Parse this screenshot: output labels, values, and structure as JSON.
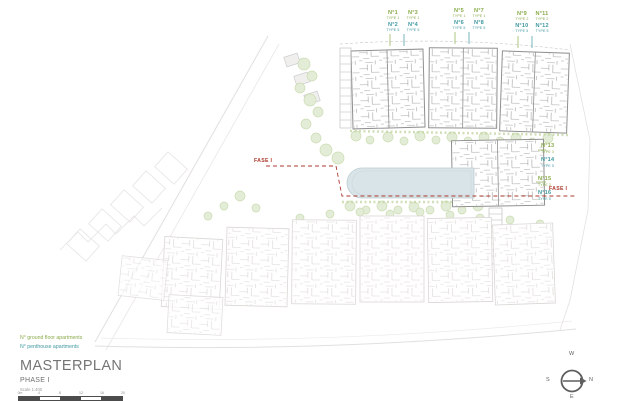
{
  "drawing": {
    "units": {
      "groups": [
        {
          "ground": [
            {
              "no": "N°1",
              "type": "TYPE 1"
            },
            {
              "no": "N°3",
              "type": "TYPE 1"
            }
          ],
          "penthouse": [
            {
              "no": "N°2",
              "type": "TYPE 5"
            },
            {
              "no": "N°4",
              "type": "TYPE 5"
            }
          ]
        },
        {
          "ground": [
            {
              "no": "N°5",
              "type": "TYPE 1"
            },
            {
              "no": "N°7",
              "type": "TYPE 1"
            }
          ],
          "penthouse": [
            {
              "no": "N°6",
              "type": "TYPE 5"
            },
            {
              "no": "N°8",
              "type": "TYPE 5"
            }
          ]
        },
        {
          "ground": [
            {
              "no": "N°9",
              "type": "TYPE 2"
            },
            {
              "no": "N°11",
              "type": "TYPE 2"
            }
          ],
          "penthouse": [
            {
              "no": "N°10",
              "type": "TYPE 5"
            },
            {
              "no": "N°12",
              "type": "TYPE 5"
            }
          ]
        }
      ],
      "side": [
        {
          "ground": {
            "no": "N°13",
            "type": "TYPE 3"
          },
          "penthouse": {
            "no": "N°14",
            "type": "TYPE 5"
          }
        },
        {
          "ground": {
            "no": "N°15",
            "type": "TYPE 3"
          },
          "penthouse": {
            "no": "N°16",
            "type": "TYPE 5"
          }
        }
      ]
    },
    "phase_boundary": {
      "label_left": "FASE I",
      "label_right": "FASE I"
    },
    "legend": {
      "ground_floor": "N° ground floor apartments",
      "penthouse": "N° penthouse apartments"
    },
    "title_block": {
      "title": "MASTERPLAN",
      "phase": "PHASE I",
      "scale_note": "Scale 1:400"
    },
    "scale_bar": {
      "ticks": [
        "0m",
        "4",
        "8",
        "12",
        "16",
        "20"
      ]
    },
    "compass": {
      "top": "W",
      "right": "N",
      "bottom": "E",
      "left": "S"
    },
    "colors": {
      "ground_floor_accent": "#8aab4a",
      "penthouse_accent": "#3f98a0",
      "phase_accent": "#ad3a2f"
    }
  }
}
